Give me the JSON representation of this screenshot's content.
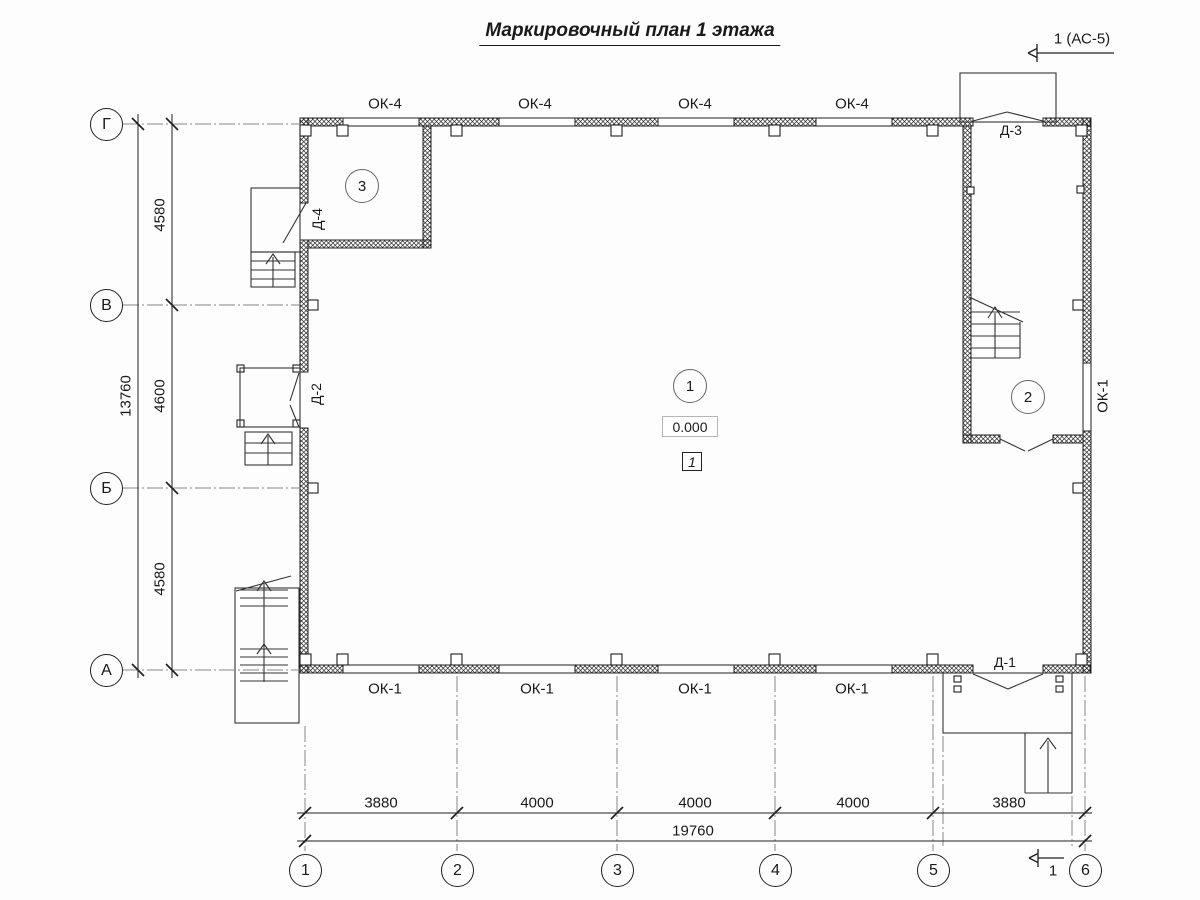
{
  "title": "Маркировочный план 1 этажа",
  "section_top": {
    "label": "1 (АС-5)"
  },
  "section_bottom": {
    "label": "1"
  },
  "axes": {
    "rows": [
      "Г",
      "В",
      "Б",
      "А"
    ],
    "cols": [
      "1",
      "2",
      "3",
      "4",
      "5",
      "6"
    ]
  },
  "dimensions": {
    "left_segments": [
      "4580",
      "4600",
      "4580"
    ],
    "left_total": "13760",
    "bottom_segments": [
      "3880",
      "4000",
      "4000",
      "4000",
      "3880"
    ],
    "bottom_total": "19760"
  },
  "windows": {
    "top": [
      "ОК-4",
      "ОК-4",
      "ОК-4",
      "ОК-4"
    ],
    "bottom": [
      "ОК-1",
      "ОК-1",
      "ОК-1",
      "ОК-1"
    ],
    "right": "ОК-1"
  },
  "doors": {
    "d1": "Д-1",
    "d2": "Д-2",
    "d3": "Д-3",
    "d4": "Д-4"
  },
  "rooms": {
    "r1": "1",
    "r2": "2",
    "r3": "3"
  },
  "elevation": "0.000",
  "detail_marker": "1",
  "colors": {
    "line": "#1f1f1f",
    "thin_line": "#333333",
    "axis_line": "#888888",
    "background": "#fdfdfd"
  }
}
